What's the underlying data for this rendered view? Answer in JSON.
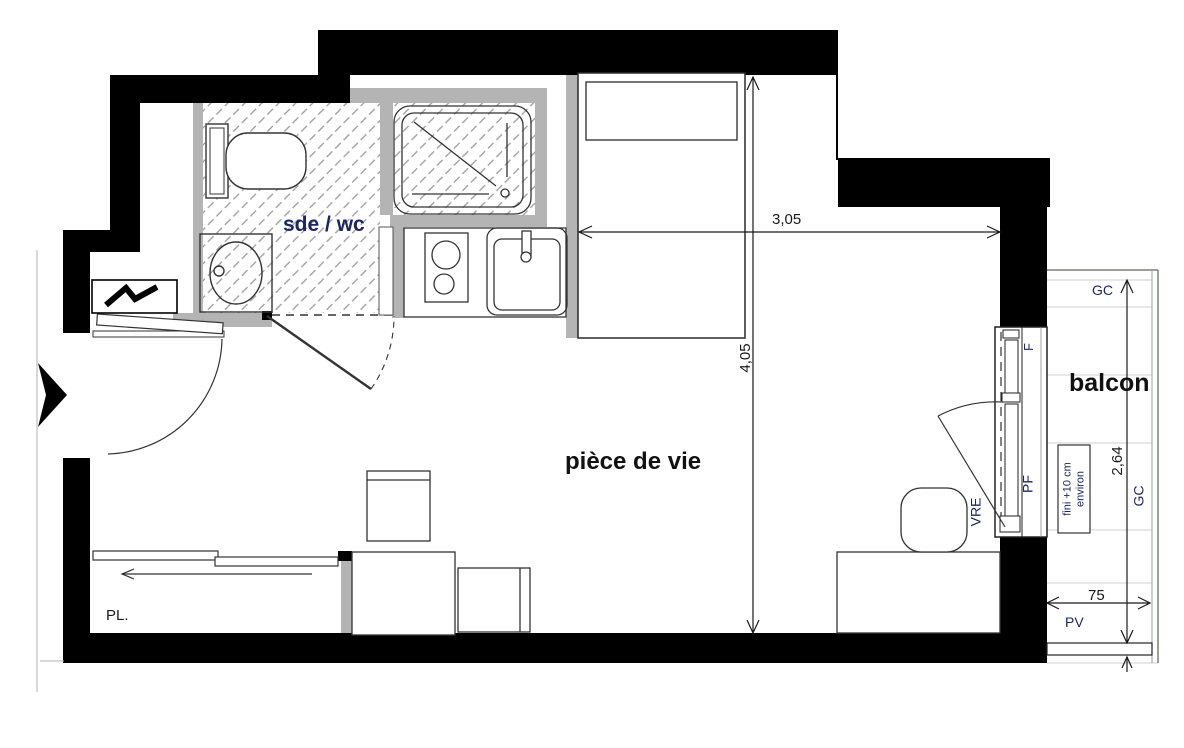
{
  "rooms": {
    "bathroom": "sde / wc",
    "living": "pièce de vie",
    "balcony": "balcon",
    "closet": "PL."
  },
  "dimensions": {
    "living_width": "3,05",
    "living_height": "4,05",
    "balcony_depth": "2,64",
    "balcony_rail_width": "75"
  },
  "annotations": {
    "gc_top": "GC",
    "gc_side": "GC",
    "pv": "PV",
    "window_fixed": "F",
    "window_door": "PF",
    "shutter": "VRE",
    "finish_note_line1": "fini +10 cm",
    "finish_note_line2": "environ"
  },
  "icons": {
    "electrical_panel": "lightning-bolt-icon",
    "entrance": "entrance-arrow-icon"
  },
  "colors": {
    "wall": "#000000",
    "partition": "#b4b4b4",
    "hatch": "#9a9a9a",
    "annotation_text": "#1b2666",
    "dimension_text": "#1a1a1a",
    "balcony_outline": "#76826e"
  }
}
